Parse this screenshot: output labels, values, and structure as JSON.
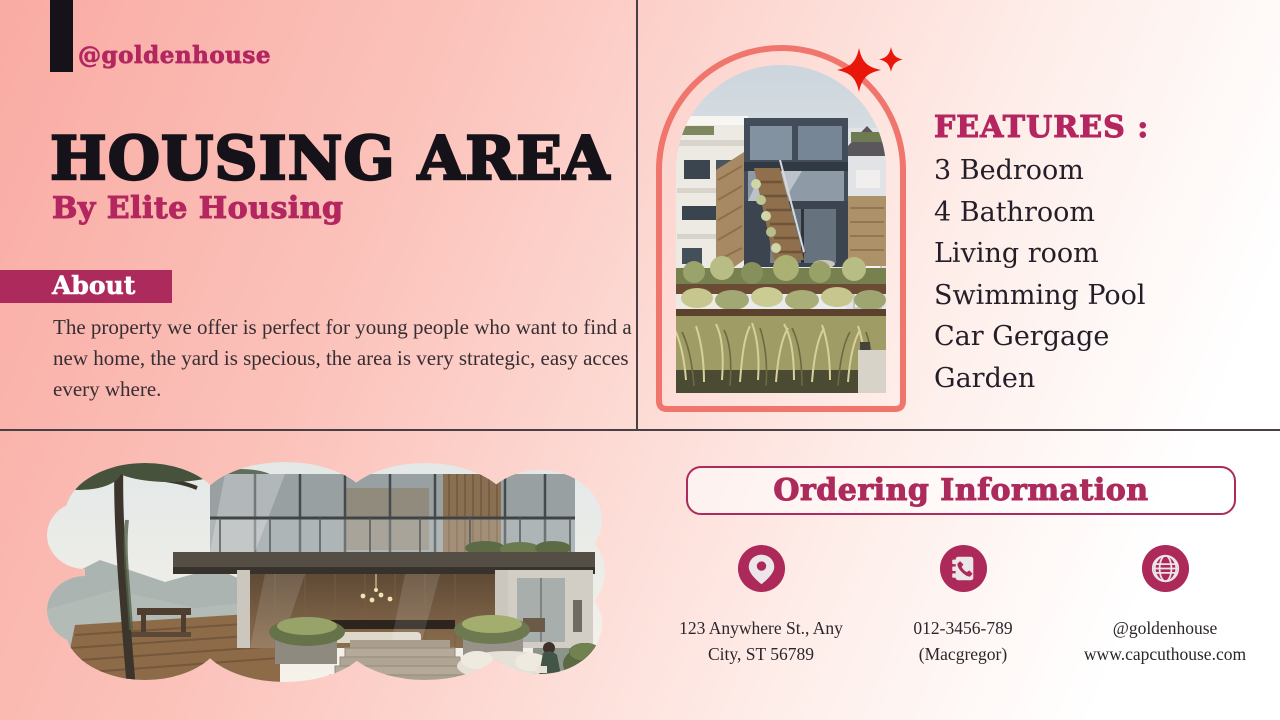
{
  "brand": {
    "handle": "@goldenhouse"
  },
  "hero": {
    "title": "HOUSING AREA",
    "subtitle": "By Elite Housing"
  },
  "about": {
    "label": "About",
    "body": "The property we offer is perfect for young people who want to find a new home, the yard is specious, the area is very strategic, easy acces every where."
  },
  "features": {
    "heading": "FEATURES :",
    "items": [
      "3 Bedroom",
      "4 Bathroom",
      "Living room",
      "Swimming Pool",
      "Car Gergage",
      "Garden"
    ]
  },
  "ordering": {
    "heading": "Ordering Information",
    "contacts": [
      {
        "icon": "location-pin-icon",
        "line1": "123 Anywhere St., Any",
        "line2": "City, ST 56789"
      },
      {
        "icon": "phone-book-icon",
        "line1": "012-3456-789",
        "line2": "(Macgregor)"
      },
      {
        "icon": "globe-icon",
        "line1": "@goldenhouse",
        "line2": "www.capcuthouse.com"
      }
    ]
  },
  "colors": {
    "accent_magenta": "#b3265f",
    "about_bar": "#ad2a5c",
    "arch_border": "#f0756c",
    "sparkle_red": "#e8170a",
    "title_black": "#16121a",
    "body_text": "#362e33",
    "divider": "#4a3f45",
    "background_left": "#f9aba3",
    "background_right": "#ffffff"
  }
}
